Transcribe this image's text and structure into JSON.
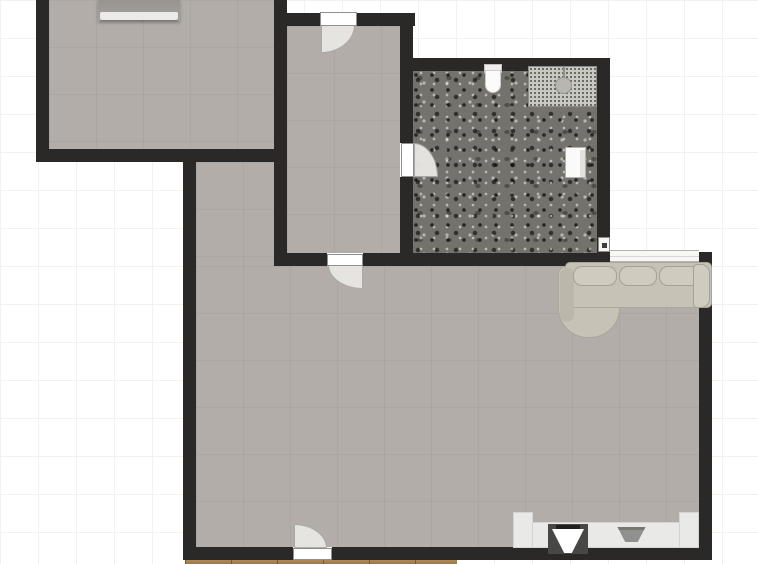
{
  "canvas": {
    "width": 758,
    "height": 564,
    "grid_size": 38
  },
  "palette": {
    "bg": "#ffffff",
    "grid": "#f2f1ee",
    "wall": "#2a2927",
    "floor": "#b2ada8",
    "bathfloor": "#73726c",
    "sofa": "#c6c2b6",
    "cushion": "#cfcbbf",
    "counter": "#e9e9e7",
    "wood": "#b2884e",
    "fan": "#e8e7e3",
    "door": "#ffffff",
    "window": "#f7f7f5"
  },
  "elements": [
    {
      "name": "bedroom-floor",
      "cls": "floor",
      "x": 49,
      "y": 0,
      "w": 225,
      "h": 149,
      "inter": true
    },
    {
      "name": "hallway-floor",
      "cls": "floor",
      "x": 287,
      "y": 26,
      "w": 113,
      "h": 227,
      "inter": true
    },
    {
      "name": "living-room-floor",
      "cls": "floor",
      "x": 196,
      "y": 162,
      "w": 78,
      "h": 385,
      "inter": true
    },
    {
      "name": "living-room-floor",
      "cls": "floor",
      "x": 196,
      "y": 266,
      "w": 503,
      "h": 281,
      "inter": true
    },
    {
      "name": "living-room-floor",
      "cls": "floor",
      "x": 610,
      "y": 256,
      "w": 89,
      "h": 30,
      "inter": true
    },
    {
      "name": "bathroom-floor",
      "cls": "floor-bath",
      "x": 413,
      "y": 71,
      "w": 184,
      "h": 182,
      "inter": true
    },
    {
      "name": "balcony-wood-floor",
      "cls": "wood",
      "x": 185,
      "y": 556,
      "w": 272,
      "h": 8,
      "inter": true
    },
    {
      "name": "window",
      "cls": "window",
      "x": 610,
      "y": 250,
      "w": 89,
      "h": 12,
      "inter": true
    },
    {
      "name": "bedroom-left-wall",
      "cls": "wall",
      "x": 36,
      "y": 0,
      "w": 13,
      "h": 162,
      "inter": true
    },
    {
      "name": "bedroom-bottom-wall",
      "cls": "wall",
      "x": 36,
      "y": 149,
      "w": 251,
      "h": 13,
      "inter": true
    },
    {
      "name": "hallway-left-wall",
      "cls": "wall",
      "x": 274,
      "y": 0,
      "w": 13,
      "h": 266,
      "inter": true
    },
    {
      "name": "hallway-top-wall",
      "cls": "wall",
      "x": 274,
      "y": 13,
      "w": 47,
      "h": 13,
      "inter": true
    },
    {
      "name": "hallway-top-wall",
      "cls": "wall",
      "x": 357,
      "y": 13,
      "w": 58,
      "h": 13,
      "inter": true
    },
    {
      "name": "hallway-right-wall",
      "cls": "wall",
      "x": 400,
      "y": 13,
      "w": 13,
      "h": 130,
      "inter": true
    },
    {
      "name": "hallway-right-wall",
      "cls": "wall",
      "x": 400,
      "y": 177,
      "w": 13,
      "h": 89,
      "inter": true
    },
    {
      "name": "hallway-bottom-wall",
      "cls": "wall",
      "x": 274,
      "y": 253,
      "w": 53,
      "h": 13,
      "inter": true
    },
    {
      "name": "bathroom-bottom-wall",
      "cls": "wall",
      "x": 363,
      "y": 253,
      "w": 247,
      "h": 13,
      "inter": true
    },
    {
      "name": "bathroom-top-wall",
      "cls": "wall",
      "x": 400,
      "y": 58,
      "w": 210,
      "h": 13,
      "inter": true
    },
    {
      "name": "bathroom-right-wall",
      "cls": "wall",
      "x": 597,
      "y": 58,
      "w": 13,
      "h": 208,
      "inter": true
    },
    {
      "name": "living-room-left-wall",
      "cls": "wall",
      "x": 183,
      "y": 149,
      "w": 13,
      "h": 411,
      "inter": true
    },
    {
      "name": "living-room-bottom-wall",
      "cls": "wall",
      "x": 183,
      "y": 547,
      "w": 110,
      "h": 13,
      "inter": true
    },
    {
      "name": "living-room-bottom-wall",
      "cls": "wall",
      "x": 332,
      "y": 547,
      "w": 380,
      "h": 13,
      "inter": true
    },
    {
      "name": "living-room-right-wall",
      "cls": "wall",
      "x": 699,
      "y": 252,
      "w": 13,
      "h": 308,
      "inter": true
    },
    {
      "name": "entry-door-swing-arc",
      "cls": "fan fan-br",
      "x": 321,
      "y": 25,
      "w": 34,
      "h": 28,
      "inter": false
    },
    {
      "name": "entry-door",
      "cls": "door",
      "x": 320,
      "y": 12,
      "w": 37,
      "h": 14,
      "inter": true
    },
    {
      "name": "hallway-door-swing-arc",
      "cls": "fan fan-bl",
      "x": 328,
      "y": 265,
      "w": 35,
      "h": 24,
      "inter": false
    },
    {
      "name": "hallway-door",
      "cls": "door",
      "x": 327,
      "y": 254,
      "w": 36,
      "h": 12,
      "inter": true
    },
    {
      "name": "bathroom-door-swing-arc",
      "cls": "fan fan-tr",
      "x": 414,
      "y": 143,
      "w": 24,
      "h": 34,
      "inter": false
    },
    {
      "name": "bathroom-door",
      "cls": "door",
      "x": 401,
      "y": 143,
      "w": 13,
      "h": 34,
      "inter": true
    },
    {
      "name": "balcony-door-swing-arc",
      "cls": "fan fan-tr",
      "x": 294,
      "y": 524,
      "w": 33,
      "h": 24,
      "inter": false
    },
    {
      "name": "balcony-door",
      "cls": "door",
      "x": 293,
      "y": 548,
      "w": 39,
      "h": 12,
      "inter": true
    },
    {
      "name": "bed",
      "cls": "bed",
      "x": 98,
      "y": 0,
      "w": 82,
      "h": 21,
      "inter": true,
      "children": [
        {
          "name": "bed-sheet",
          "cls": "bed-sheet",
          "x": 2,
          "y": 12,
          "w": 78,
          "h": 8,
          "inter": false
        }
      ]
    },
    {
      "name": "toilet",
      "cls": "toilet",
      "x": 484,
      "y": 64,
      "w": 18,
      "h": 29,
      "inter": true,
      "children": [
        {
          "name": "toilet-tank",
          "cls": "toilet-tank",
          "x": 0,
          "y": 0,
          "w": 18,
          "h": 9,
          "inter": false
        },
        {
          "name": "toilet-bowl",
          "cls": "toilet-bowl",
          "x": 1,
          "y": 6,
          "w": 16,
          "h": 23,
          "inter": false
        }
      ]
    },
    {
      "name": "shower",
      "cls": "shower",
      "x": 528,
      "y": 66,
      "w": 69,
      "h": 41,
      "inter": true,
      "children": [
        {
          "name": "shower-stem-icon",
          "cls": "shower-stem",
          "x": 34,
          "y": 0,
          "w": 2,
          "h": 13,
          "inter": false
        },
        {
          "name": "shower-head-icon",
          "cls": "shower-head",
          "x": 26,
          "y": 10,
          "w": 17,
          "h": 17,
          "inter": false
        }
      ]
    },
    {
      "name": "bathroom-sink",
      "cls": "bsink",
      "x": 565,
      "y": 147,
      "w": 21,
      "h": 31,
      "inter": true,
      "children": [
        {
          "name": "sink-basin",
          "cls": "bsink-in",
          "x": 14,
          "y": 2,
          "w": 5,
          "h": 27,
          "inter": false
        }
      ]
    },
    {
      "name": "wall-fixture",
      "cls": "wallbox",
      "x": 598,
      "y": 237,
      "w": 12,
      "h": 15,
      "inter": true,
      "children": [
        {
          "name": "wall-fixture-dot",
          "cls": "wallbox-dot",
          "x": 3,
          "y": 5,
          "w": 5,
          "h": 5,
          "inter": false
        }
      ]
    },
    {
      "name": "sofa",
      "cls": "sofa-group",
      "x": 558,
      "y": 262,
      "w": 154,
      "h": 78,
      "inter": true,
      "children": [
        {
          "name": "sofa-chaise",
          "cls": "sofa-chaise",
          "x": 0,
          "y": 4,
          "w": 62,
          "h": 72,
          "inter": false
        },
        {
          "name": "sofa-body",
          "cls": "sofa-body",
          "x": 7,
          "y": 0,
          "w": 147,
          "h": 46,
          "inter": false
        },
        {
          "name": "sofa-armrest-left",
          "cls": "sofa-armin",
          "x": 2,
          "y": 6,
          "w": 14,
          "h": 54,
          "inter": false
        },
        {
          "name": "sofa-cushion",
          "cls": "sofa-cushion",
          "x": 15,
          "y": 4,
          "w": 44,
          "h": 20,
          "inter": false
        },
        {
          "name": "sofa-cushion",
          "cls": "sofa-cushion",
          "x": 61,
          "y": 4,
          "w": 38,
          "h": 20,
          "inter": false
        },
        {
          "name": "sofa-cushion",
          "cls": "sofa-cushion",
          "x": 101,
          "y": 4,
          "w": 45,
          "h": 20,
          "inter": false
        },
        {
          "name": "sofa-armrest-right",
          "cls": "sofa-arm",
          "x": 135,
          "y": 2,
          "w": 17,
          "h": 44,
          "inter": false
        }
      ]
    },
    {
      "name": "kitchen-counter",
      "cls": "counter-group",
      "x": 513,
      "y": 512,
      "w": 186,
      "h": 36,
      "inter": true,
      "children": [
        {
          "name": "counter-top",
          "cls": "counter",
          "x": 0,
          "y": 10,
          "w": 186,
          "h": 26,
          "inter": false
        },
        {
          "name": "counter-cabinet",
          "cls": "counter",
          "x": 0,
          "y": 0,
          "w": 20,
          "h": 36,
          "inter": false
        },
        {
          "name": "counter-cabinet",
          "cls": "counter",
          "x": 166,
          "y": 0,
          "w": 20,
          "h": 36,
          "inter": false
        },
        {
          "name": "kitchen-sink",
          "cls": "ksink",
          "x": 35,
          "y": 12,
          "w": 40,
          "h": 30,
          "inter": true,
          "children": [
            {
              "name": "sink-basin-icon",
              "cls": "ksink-basin",
              "x": 4,
              "y": 5,
              "w": 32,
              "h": 24,
              "inter": false
            },
            {
              "name": "faucet-icon",
              "cls": "ksink-bar",
              "x": 8,
              "y": 1,
              "w": 24,
              "h": 4,
              "inter": false
            }
          ]
        },
        {
          "name": "stove",
          "cls": "stove",
          "x": 101,
          "y": 15,
          "w": 35,
          "h": 15,
          "inter": true
        }
      ]
    }
  ]
}
